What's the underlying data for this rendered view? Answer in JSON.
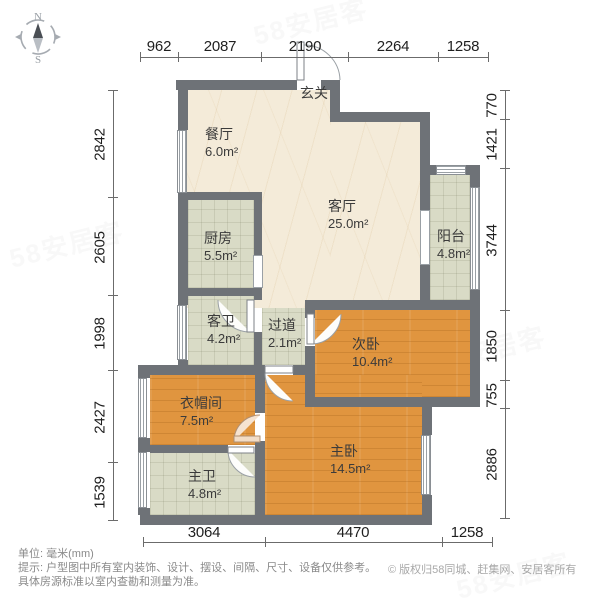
{
  "compass": {
    "north_label": "N",
    "south_label": "S"
  },
  "dimensions": {
    "unit": "mm",
    "top": {
      "values": [
        "962",
        "2087",
        "2190",
        "2264",
        "1258"
      ]
    },
    "left": {
      "values": [
        "2842",
        "2605",
        "1998",
        "2427",
        "1539"
      ]
    },
    "right": {
      "values": [
        "770",
        "1421",
        "3744",
        "1850",
        "755",
        "2886"
      ]
    },
    "bottom": {
      "values": [
        "3064",
        "4470",
        "1258"
      ]
    }
  },
  "rooms": {
    "entry": {
      "name": "玄关",
      "area": ""
    },
    "dining": {
      "name": "餐厅",
      "area": "6.0m²"
    },
    "living": {
      "name": "客厅",
      "area": "25.0m²"
    },
    "kitchen": {
      "name": "厨房",
      "area": "5.5m²"
    },
    "balcony": {
      "name": "阳台",
      "area": "4.8m²"
    },
    "guest_bath": {
      "name": "客卫",
      "area": "4.2m²"
    },
    "hallway": {
      "name": "过道",
      "area": "2.1m²"
    },
    "second_bedroom": {
      "name": "次卧",
      "area": "10.4m²"
    },
    "cloakroom": {
      "name": "衣帽间",
      "area": "7.5m²"
    },
    "master_bedroom": {
      "name": "主卧",
      "area": "14.5m²"
    },
    "master_bath": {
      "name": "主卫",
      "area": "4.8m²"
    }
  },
  "footer": {
    "unit_note": "单位: 毫米(mm)",
    "tip_line1": "提示: 户型图中所有室内装饰、设计、摆设、间隔、尺寸、设备仅供参考。",
    "tip_line2": "具体房源标准以室内查勘和测量为准。",
    "copyright": "© 版权归58同城、赶集网、安居客所有"
  },
  "watermark_text": "58安居客",
  "colors": {
    "wall": "#6e7277",
    "marble_floor": "#f4ebd9",
    "tile_floor": "#d9dbc6",
    "wood_floor": "#e0953f",
    "dim_text": "#1f1f1f",
    "note_text": "#8a8a8a"
  }
}
